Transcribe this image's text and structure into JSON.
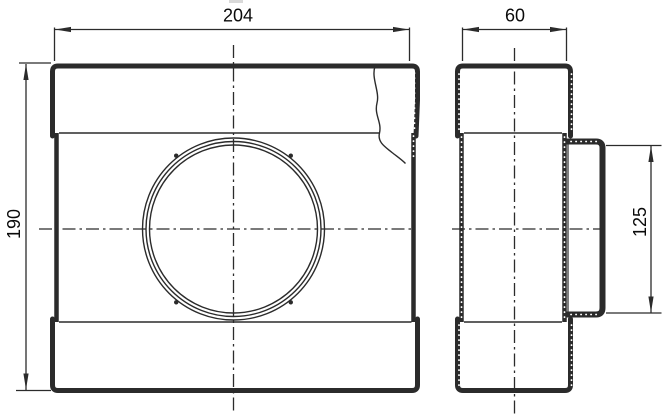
{
  "dimensions": {
    "front_width": "204",
    "side_depth": "60",
    "front_height": "190",
    "spigot_diameter": "125"
  },
  "colors": {
    "line": "#2b2b2b",
    "text": "#0a0a0a",
    "background": "#ffffff"
  }
}
